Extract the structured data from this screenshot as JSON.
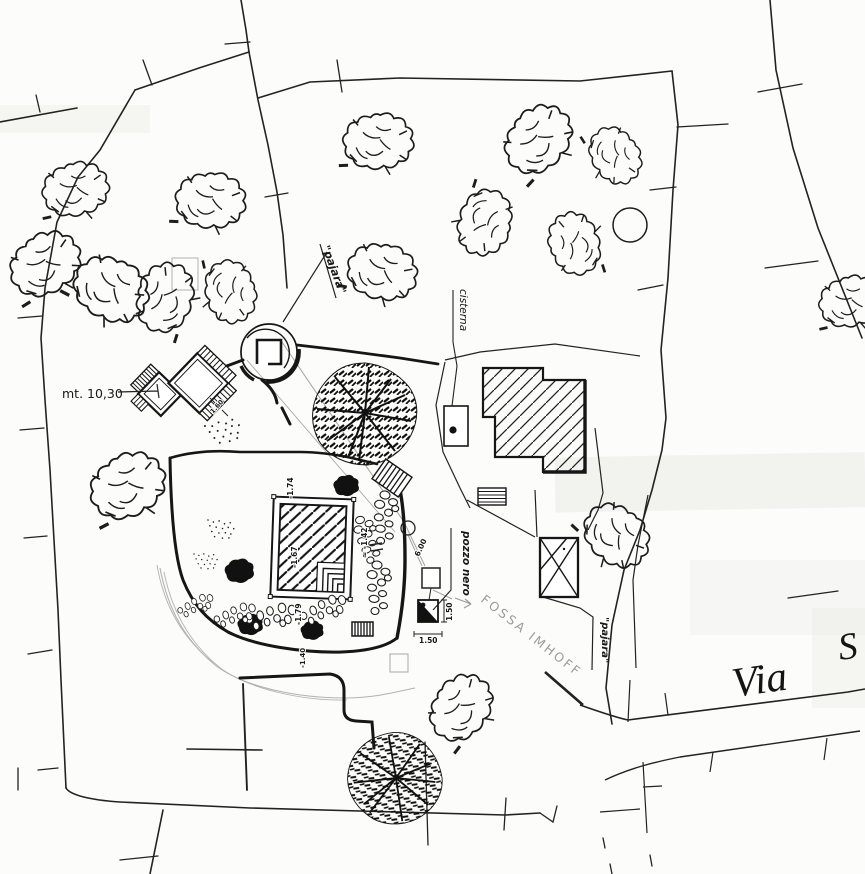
{
  "labels": {
    "pajara_upper": "\"pajara\"",
    "pajara_lower": "\"pajara\"",
    "cisterna": "cisterna",
    "pozzo_nero": "pozzo nero",
    "fossa_imhoff": "FOSSA IMHOFF",
    "via": "Via",
    "via_street_initial": "S"
  },
  "measurements": {
    "building_width": "mt. 10,30",
    "building_side": "1.60",
    "pozzo_width": "1.50",
    "pozzo_height": "1.50",
    "path_length": "6.00",
    "pool_depth_top": "-1.74",
    "pool_depth_inside": "-1.67",
    "pool_depth_bottom": "-1.79",
    "pool_depth_right": "≈ -1.42",
    "path_depth": "-1.40"
  },
  "colors": {
    "ink": "#1a1a1a",
    "pencil": "#9c9c96",
    "wash": "#e8e8e3"
  }
}
